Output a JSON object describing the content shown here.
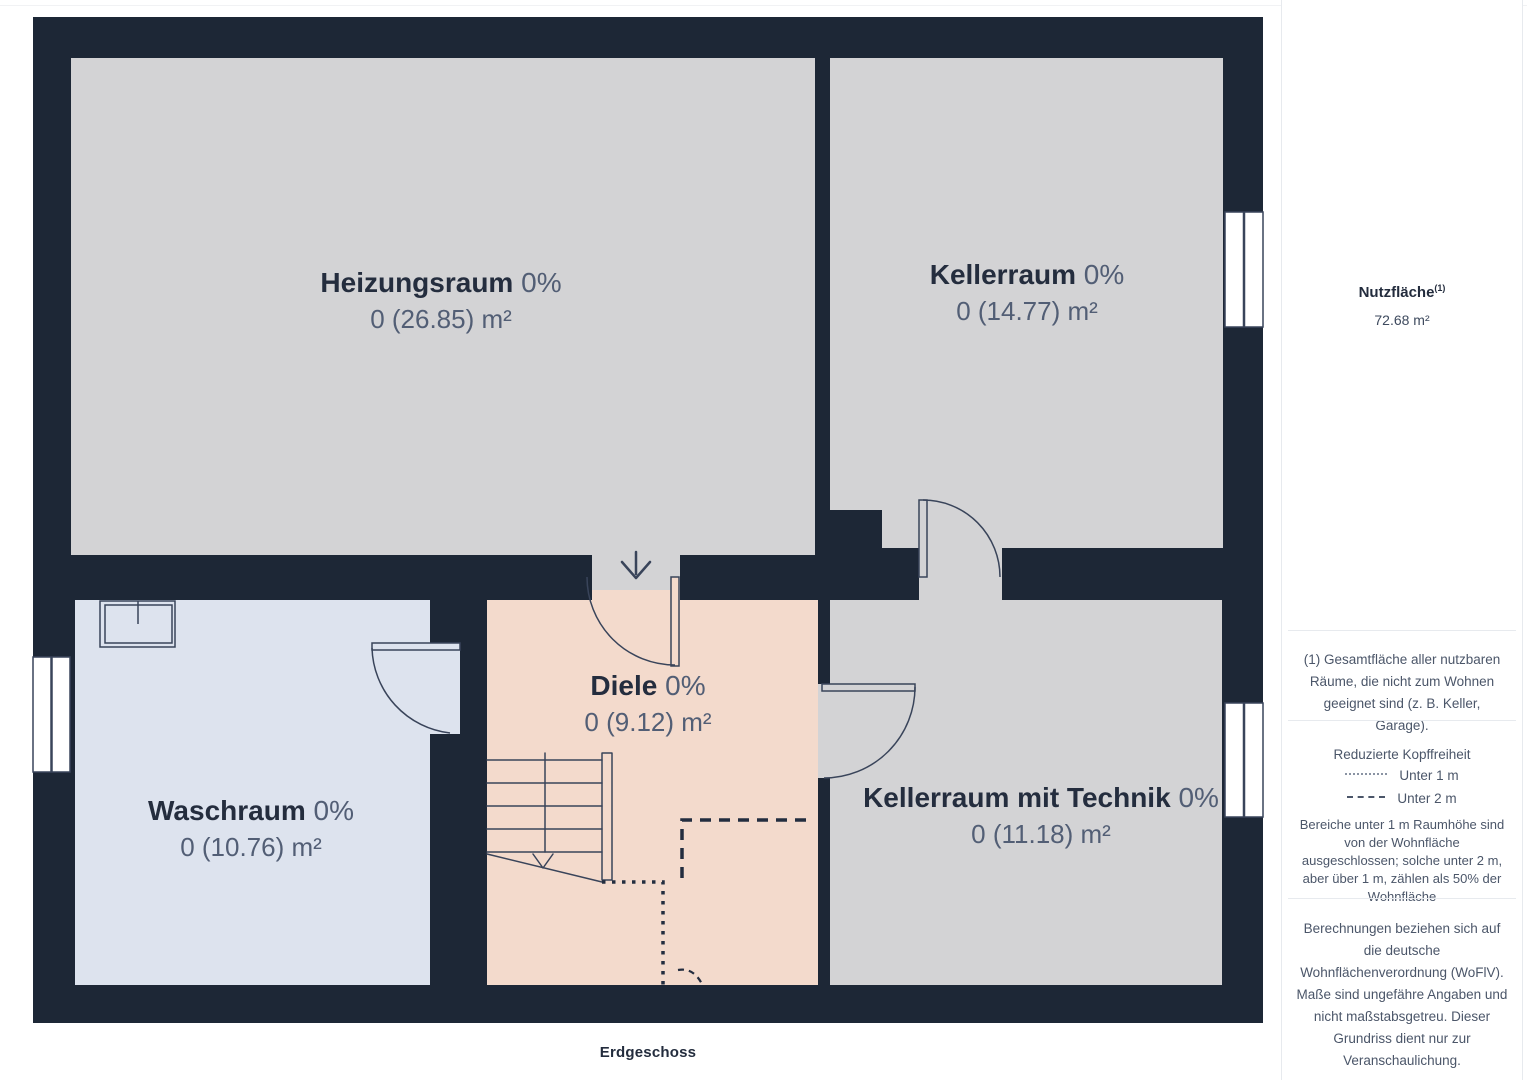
{
  "plan": {
    "floor_label": "Erdgeschoss",
    "rooms": [
      {
        "id": "heizungsraum",
        "name": "Heizungsraum",
        "percent": "0%",
        "area": "0 (26.85) m²"
      },
      {
        "id": "kellerraum",
        "name": "Kellerraum",
        "percent": "0%",
        "area": "0 (14.77) m²"
      },
      {
        "id": "waschraum",
        "name": "Waschraum",
        "percent": "0%",
        "area": "0 (10.76) m²"
      },
      {
        "id": "diele",
        "name": "Diele",
        "percent": "0%",
        "area": "0 (9.12) m²"
      },
      {
        "id": "kellerraum-technik",
        "name": "Kellerraum mit Technik",
        "percent": "0%",
        "area": "0 (11.18) m²"
      }
    ],
    "colors": {
      "wall": "#1d2736",
      "room_gray": "#d3d3d5",
      "room_blue": "#dde3ee",
      "room_pink": "#f3dacc",
      "linework": "#333e52",
      "room_name_text": "#242d3e",
      "room_secondary_text": "#525e75"
    }
  },
  "sidebar": {
    "area_label": "Nutzfläche",
    "area_footnote_marker": "(1)",
    "area_value": "72.68 m²",
    "footnote": "(1) Gesamtfläche aller nutzbaren Räume, die nicht zum Wohnen geeignet sind (z. B. Keller, Garage).",
    "headroom": {
      "title": "Reduzierte Kopffreiheit",
      "legend": [
        {
          "style": "dotted",
          "label": "Unter 1 m"
        },
        {
          "style": "dashed",
          "label": "Unter 2 m"
        }
      ],
      "note": "Bereiche unter 1 m Raumhöhe sind von der Wohnfläche ausgeschlossen; solche unter 2 m, aber über 1 m, zählen als 50% der Wohnfläche"
    },
    "disclaimer": "Berechnungen beziehen sich auf die deutsche Wohnflächenverordnung (WoFlV). Maße sind ungefähre Angaben und nicht maßstabsgetreu. Dieser Grundriss dient nur zur Veranschaulichung.",
    "brand": {
      "name": "GIRAFFE",
      "suffix": "360"
    }
  }
}
